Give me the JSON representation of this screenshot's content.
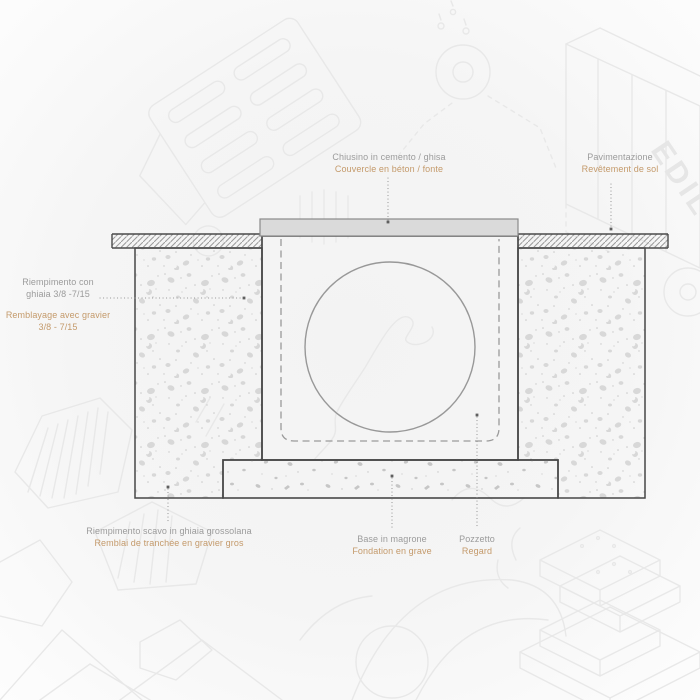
{
  "colors": {
    "label_gray": "#9b9b9b",
    "label_accent": "#c49a6b",
    "structure_line": "#474747",
    "cover_fill": "#dadada",
    "hidden_line_gray": "#9a9a9a"
  },
  "labels": {
    "cover": {
      "it": "Chiusino in cemento / ghisa",
      "fr": "Couvercle en béton / fonte"
    },
    "paving": {
      "it": "Pavimentazione",
      "fr": "Revêtement de sol"
    },
    "gravel_fill": {
      "it_line1": "Riempimento con",
      "it_line2": "ghiaia 3/8 -7/15",
      "fr_line1": "Remblayage avec gravier",
      "fr_line2": "3/8 - 7/15"
    },
    "trench_fill": {
      "it": "Riempimento scavo in ghiaia grossolana",
      "fr": "Remblai de tranchée en gravier gros"
    },
    "base": {
      "it": "Base in magrone",
      "fr": "Fondation en grave"
    },
    "pit": {
      "it": "Pozzetto",
      "fr": "Regard"
    }
  },
  "background": {
    "truck_brand": "EDIL"
  }
}
